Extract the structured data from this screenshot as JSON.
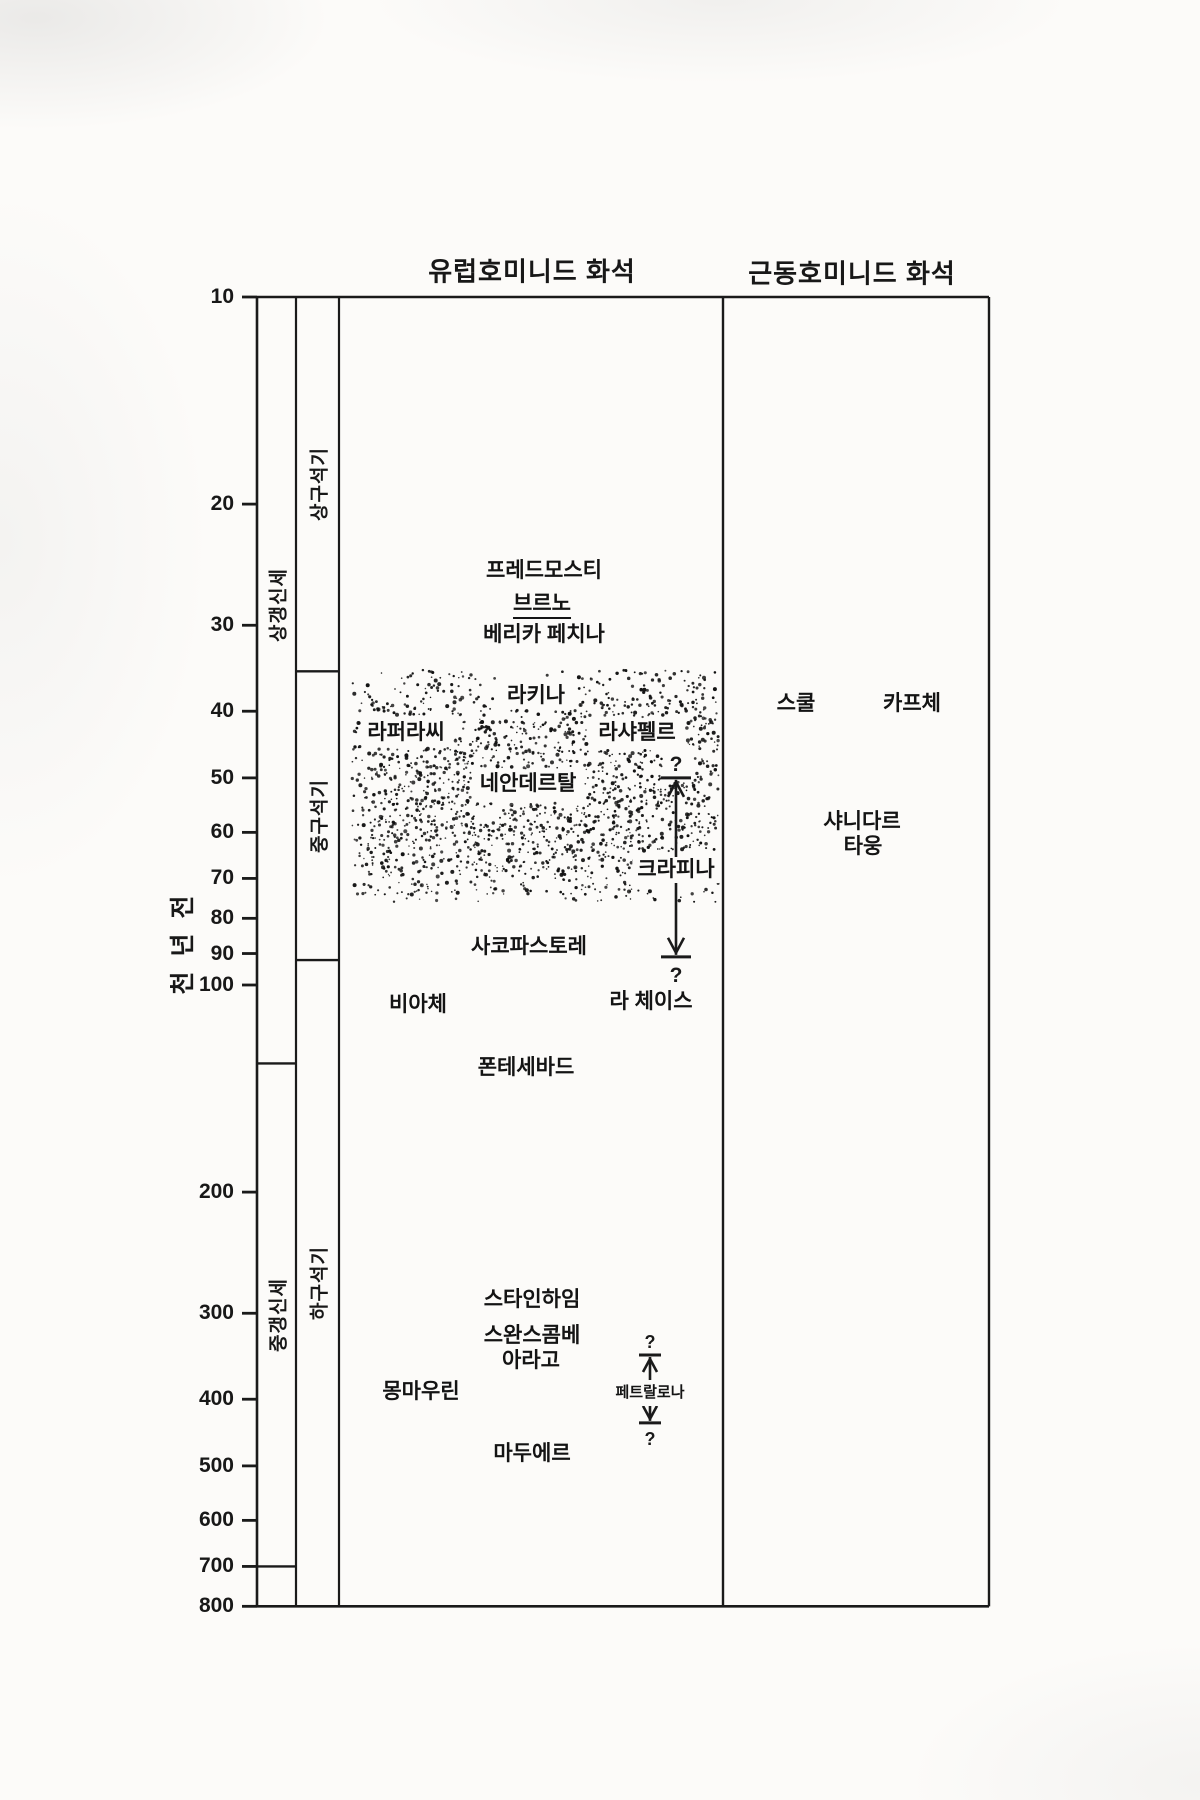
{
  "style": {
    "ink": "#1a1a1a",
    "paper": "#fcfbf9"
  },
  "chart_data": {
    "type": "scatter",
    "description_visible_text_only": true,
    "panels": {
      "europe": {
        "title": "유럽호미니드 화석",
        "fossils": [
          {
            "name": "프레드모스티",
            "time_ky": 25,
            "x": 544
          },
          {
            "name": "브르노",
            "time_ky": 28,
            "x": 542,
            "underline": true
          },
          {
            "name": "베리카 페치나",
            "time_ky": 31,
            "x": 544
          },
          {
            "name": "라키나",
            "time_ky": 38,
            "x": 536
          },
          {
            "name": "라퍼라씨",
            "time_ky": 43,
            "x": 406
          },
          {
            "name": "라샤펠르",
            "time_ky": 43,
            "x": 637
          },
          {
            "name": "네안데르탈",
            "time_ky": 51,
            "x": 528
          },
          {
            "name": "사코파스토레",
            "time_ky": 88,
            "x": 529
          },
          {
            "name": "비아체",
            "time_ky": 107,
            "x": 418
          },
          {
            "name": "라 체이스",
            "time_ky": 106,
            "x": 651
          },
          {
            "name": "폰테세바드",
            "time_ky": 132,
            "x": 526
          },
          {
            "name": "스타인하임",
            "time_ky": 287,
            "x": 532
          },
          {
            "name": "스완스콤베",
            "time_ky": 324,
            "x": 532
          },
          {
            "name": "아라고",
            "time_ky": 352,
            "x": 531
          },
          {
            "name": "몽마우린",
            "time_ky": 390,
            "x": 421
          },
          {
            "name": "마두에르",
            "time_ky": 481,
            "x": 532
          }
        ]
      },
      "near_east": {
        "title": "근동호미니드 화석",
        "fossils": [
          {
            "name": "스쿨",
            "time_ky": 39,
            "x": 796
          },
          {
            "name": "카프체",
            "time_ky": 39,
            "x": 912
          },
          {
            "name": "샤니다르",
            "time_ky": 58,
            "x": 862
          },
          {
            "name": "타웅",
            "time_ky": 63,
            "x": 863
          }
        ]
      }
    },
    "range_markers": [
      {
        "label": "크라피나",
        "label_time_ky": 68,
        "x": 676,
        "range_from_ky": 50,
        "range_to_ky": 91,
        "question_mark": "?",
        "small": false
      },
      {
        "label": "페트랄로나",
        "label_time_ky": 392,
        "x": 650,
        "range_from_ky": 345,
        "range_to_ky": 433,
        "question_mark": "?",
        "small": true
      }
    ],
    "y_axis": {
      "label": "천 년 전",
      "scale": "log",
      "range_ky": [
        10,
        800
      ],
      "ticks_ky": [
        10,
        20,
        30,
        40,
        50,
        60,
        70,
        80,
        90,
        100,
        200,
        300,
        400,
        500,
        600,
        700,
        800
      ]
    },
    "epoch_column": [
      {
        "label": "상갱신세",
        "from_ky": 10,
        "to_ky": 130,
        "label_ky": 28
      },
      {
        "label": "중갱신세",
        "from_ky": 130,
        "to_ky": 700
      },
      {
        "label": "",
        "from_ky": 700,
        "to_ky": 800
      }
    ],
    "industry_column": [
      {
        "label": "상구석기",
        "from_ky": 10,
        "to_ky": 35
      },
      {
        "label": "중구석기",
        "from_ky": 35,
        "to_ky": 92
      },
      {
        "label": "하구석기",
        "from_ky": 92,
        "to_ky": 800
      }
    ],
    "stipple_zone": {
      "from_ky": 35,
      "to_ky": 75
    }
  }
}
